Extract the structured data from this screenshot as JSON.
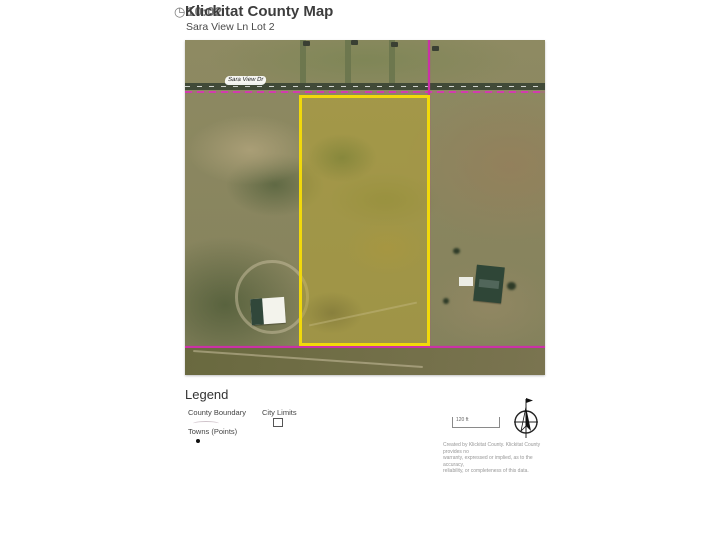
{
  "header": {
    "title": "Klickitat County Map",
    "subtitle": "Sara View Ln Lot 2",
    "timer": "10:02",
    "clock_glyph": "◷"
  },
  "map": {
    "road_label": "Sara View Dr",
    "colors": {
      "parcel_outline": "#f2d90a",
      "county_boundary": "#cb31a7",
      "road": "#414a38",
      "terrain_base": "#8e8a62"
    }
  },
  "legend": {
    "heading": "Legend",
    "items": {
      "county_boundary": "County Boundary",
      "city_limits": "City Limits",
      "towns": "Towns (Points)"
    }
  },
  "scale_bar": {
    "label": "120 ft"
  },
  "attribution": {
    "line1": "Created by Klickitat County. Klickitat County provides no",
    "line2": "warranty, expressed or implied, as to the accuracy,",
    "line3": "reliability, or completeness of this data."
  }
}
